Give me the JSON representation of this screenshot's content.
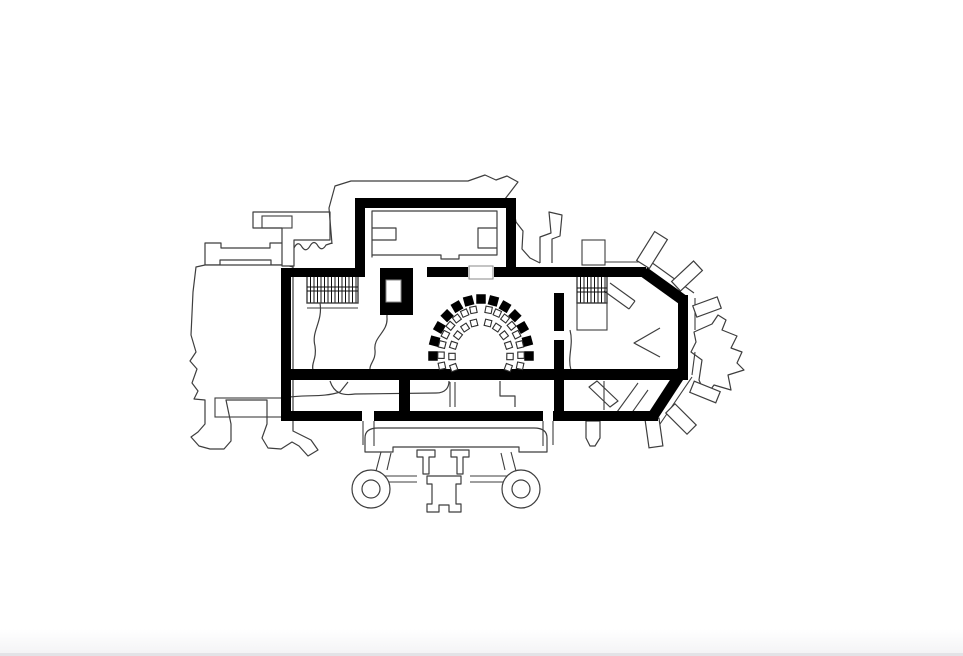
{
  "page": {
    "background": "#ffffff",
    "edge": {
      "height": 24,
      "gradient_from": "#ffffff",
      "gradient_to": "#f4f4f6",
      "border_color": "#e3e3e7",
      "border_px": 3
    }
  },
  "drawing": {
    "description": "Architectural floor plan: thick black masonry walls with stairs, elevator shaft, semicircular seating, tower, chapel, polygonal apse with buttresses and south porch",
    "colors": {
      "ink": "#000000",
      "thin": "#3e3e3e",
      "paper": "#ffffff",
      "chair_stroke": "#2e2e2e",
      "shaft_stroke": "#8a8a8a"
    },
    "wall_rects": [
      [
        281,
        268,
        10,
        153
      ],
      [
        281,
        268,
        84,
        9
      ],
      [
        355,
        198,
        10,
        79
      ],
      [
        355,
        198,
        161,
        10
      ],
      [
        506,
        198,
        10,
        70
      ],
      [
        427,
        267,
        41,
        10
      ],
      [
        494,
        267,
        152,
        10
      ],
      [
        380,
        268,
        33,
        47
      ],
      [
        678,
        295,
        10,
        80
      ],
      [
        281,
        369,
        407,
        11
      ],
      [
        281,
        411,
        81,
        10
      ],
      [
        374,
        411,
        169,
        10
      ],
      [
        553,
        411,
        105,
        10
      ],
      [
        554,
        293,
        10,
        38
      ],
      [
        554,
        340,
        10,
        71
      ],
      [
        399,
        380,
        11,
        31
      ]
    ],
    "wall_lines": [
      [
        644,
        272,
        683,
        300,
        11
      ],
      [
        683,
        370,
        653,
        416,
        11
      ]
    ],
    "white_rects": [
      [
        386,
        280,
        15,
        22
      ],
      [
        469,
        266,
        24,
        13
      ]
    ],
    "stairs": [
      {
        "x": 307,
        "y": 275,
        "w": 51,
        "h": 28,
        "step": 3.5,
        "horiz": [
          287,
          291
        ],
        "under": [
          303,
          308
        ],
        "landing": null
      },
      {
        "x": 577,
        "y": 275,
        "w": 30,
        "h": 28,
        "step": 3.5,
        "horiz": [
          288,
          292
        ],
        "under": [],
        "landing": [
          577,
          303,
          30,
          27
        ]
      }
    ],
    "seat_arc": {
      "cx": 481,
      "cy": 356,
      "rx": 48,
      "ry": 57,
      "count": 13,
      "a0": 0,
      "a1": 180,
      "size": 9.5
    },
    "chair_blocks": [
      {
        "rx": 40,
        "ry": 47,
        "a0": 101,
        "a1": 192,
        "n": 8,
        "size": 6.4
      },
      {
        "rx": 29,
        "ry": 34,
        "a0": 104,
        "a1": 200,
        "n": 6,
        "size": 6.4
      },
      {
        "rx": 40,
        "ry": 47,
        "a0": -12,
        "a1": 79,
        "n": 8,
        "size": 6.4
      },
      {
        "rx": 29,
        "ry": 34,
        "a0": -20,
        "a1": 76,
        "n": 6,
        "size": 6.4
      }
    ],
    "spokes": [
      {
        "cx": 652,
        "cy": 250,
        "w": 15,
        "l": 34,
        "rot": 32
      },
      {
        "cx": 687,
        "cy": 276,
        "w": 13,
        "l": 30,
        "rot": 47
      },
      {
        "cx": 707,
        "cy": 307,
        "w": 12,
        "l": 26,
        "rot": 70
      },
      {
        "cx": 705,
        "cy": 392,
        "w": 12,
        "l": 28,
        "rot": 112
      },
      {
        "cx": 681,
        "cy": 419,
        "w": 13,
        "l": 30,
        "rot": 135
      },
      {
        "cx": 654,
        "cy": 433,
        "w": 14,
        "l": 28,
        "rot": 172
      }
    ],
    "thin": {
      "paths": [
        {
          "d": "M205,265 V243 H221 V248 H270 V243 H286 V265 H271 V260 H220 V265 Z",
          "fill": "#ffffff"
        },
        {
          "d": "M286,265 H205 L196,267 L193,292 L191,335 L196,352 L190,361 L197,369 L192,383 L198,391 L194,399 L205,400 L205,424 L198,432 L191,437 L199,446 L210,449 L224,449 L231,441 L231,424 L226,400 L267,400 L267,424 L262,438 L268,448 L281,449 L292,442 L299,446 L308,456 L318,450 L311,440 L293,431 L293,267 Z",
          "fill": "#ffffff"
        },
        {
          "d": "M253,212 L330,212 L330,240 L294,240 L294,266 L282,266 L282,228 L253,228 Z",
          "fill": "#ffffff"
        },
        {
          "d": "M294,248 q4,-8 8,-1 q4,6 8,-1 q4,-7 8,0 q4,6 8,-1 l6,-2",
          "fill": "none"
        },
        {
          "d": "M332,244 L329,208 L335,186 L351,181 L468,181 L485,175 L496,180 L507,176 L518,182 L505,199 L513,206 L516,222 L523,231 L522,249 L530,258 L540,263",
          "fill": "none"
        },
        {
          "d": "M372,257 V211 H497 V255 H459 V259 H441 V255 H372 Z",
          "fill": "none"
        },
        {
          "d": "M372,228 H396 V240 H372",
          "fill": "none"
        },
        {
          "d": "M497,228 H478 V248 H497",
          "fill": "none"
        },
        {
          "d": "M540,263 L540,237 L551,233 L549,212 L562,215 L560,236 L552,239 L552,263",
          "fill": "none"
        },
        {
          "d": "M694,332 L712,324 L718,315 L726,320 L722,330 L737,336 L731,348 L742,352 L737,363 L744,370 L728,375 L731,390 L714,385 L706,396 L699,380 L702,360 L691,352 L696,342 Z",
          "fill": "#ffffff"
        },
        {
          "d": "M399,279 C397,300 386,304 387,318 C388,332 373,337 375,350 C376,361 369,363 370,371",
          "fill": "none"
        },
        {
          "d": "M320,303 C323,322 311,331 315,346 C317,359 311,363 313,370",
          "fill": "none"
        },
        {
          "d": "M330,381 C334,393 342,396 355,394 L436,393 C446,393 449,387 449,381",
          "fill": "none"
        },
        {
          "d": "M283,398 C305,394 322,398 340,392 L348,382",
          "fill": "none"
        },
        {
          "d": "M570,330 C574,345 567,357 571,370",
          "fill": "none"
        },
        {
          "d": "M660,328 L634,343 L660,357",
          "fill": "none"
        },
        {
          "d": "M597,381 L618,401 L610,407 L589,387 Z",
          "fill": "none"
        },
        {
          "d": "M500,381 V396 H515 V407",
          "fill": "none"
        },
        {
          "d": "M365,452 V438 Q365,428 378,428 H534 Q547,428 547,438 V452 H519 V447 H393 V452 Z",
          "fill": "#ffffff"
        },
        {
          "d": "M417,450 H435 V457 H429 V474 H423 V457 H417 Z",
          "fill": "#ffffff"
        },
        {
          "d": "M451,450 H469 V457 H463 V474 H457 V457 H451 Z",
          "fill": "#ffffff"
        },
        {
          "d": "M427,476 H461 V484 H456 V504 H461 V512 H449 V505 H439 V512 H427 V504 H432 V484 H427 Z",
          "fill": "#ffffff"
        },
        {
          "d": "M586,421 H600 V438 L595,446 H590 L586,438 Z",
          "fill": "#ffffff"
        }
      ],
      "lines": [
        [
          215,
          398,
          286,
          398
        ],
        [
          215,
          417,
          286,
          417
        ],
        [
          307,
          303,
          358,
          303
        ],
        [
          307,
          308,
          358,
          308
        ],
        [
          450,
          382,
          450,
          407
        ],
        [
          455,
          382,
          455,
          407
        ],
        [
          604,
          381,
          604,
          410
        ],
        [
          605,
          262,
          640,
          262
        ],
        [
          651,
          262,
          694,
          293
        ],
        [
          695,
          298,
          695,
          330
        ],
        [
          695,
          352,
          692,
          375
        ],
        [
          692,
          377,
          660,
          424
        ],
        [
          604,
          291,
          629,
          309
        ],
        [
          610,
          283,
          635,
          301
        ],
        [
          629,
          309,
          635,
          301
        ],
        [
          638,
          383,
          617,
          412
        ],
        [
          648,
          390,
          631,
          414
        ],
        [
          363,
          421,
          363,
          445
        ],
        [
          374,
          421,
          374,
          446
        ],
        [
          543,
          421,
          543,
          446
        ],
        [
          553,
          421,
          553,
          445
        ],
        [
          381,
          452,
          376,
          471
        ],
        [
          391,
          453,
          387,
          470
        ],
        [
          511,
          452,
          516,
          471
        ],
        [
          501,
          453,
          505,
          470
        ],
        [
          377,
          476,
          417,
          476
        ],
        [
          377,
          482,
          417,
          482
        ],
        [
          470,
          476,
          510,
          476
        ],
        [
          470,
          482,
          510,
          482
        ]
      ],
      "circles": [
        [
          371,
          489,
          19
        ],
        [
          371,
          489,
          9
        ],
        [
          521,
          489,
          19
        ],
        [
          521,
          489,
          9
        ]
      ],
      "rect_outlines": [
        [
          262,
          216,
          30,
          12
        ],
        [
          215,
          398,
          71,
          19
        ],
        [
          582,
          240,
          23,
          25
        ]
      ]
    }
  }
}
